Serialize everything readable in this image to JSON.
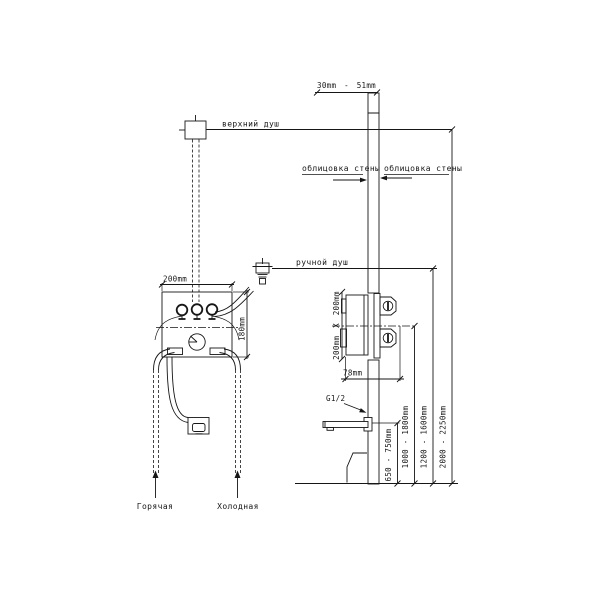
{
  "labels": {
    "overhead_shower": "верхний душ",
    "hand_shower": "ручной душ",
    "wall_cladding_left": "облицовка стены",
    "wall_cladding_right": "облицовка стены",
    "hot_water": "Горячая",
    "cold_water": "Холодная",
    "thread_size": "G1/2"
  },
  "dimensions": {
    "cladding_thickness": "30mm - 51mm",
    "mixer_width": "200mm",
    "mixer_height": "180mm",
    "recess_size": "200mm X 200mm",
    "valve_depth": "78mm",
    "spout_height": "650 - 750mm",
    "valve_height": "1000 - 1800mm",
    "hand_shower_height": "1200 - 1600mm",
    "overhead_height": "2000 - 2250mm"
  },
  "colors": {
    "line": "#161616",
    "background": "#ffffff"
  }
}
